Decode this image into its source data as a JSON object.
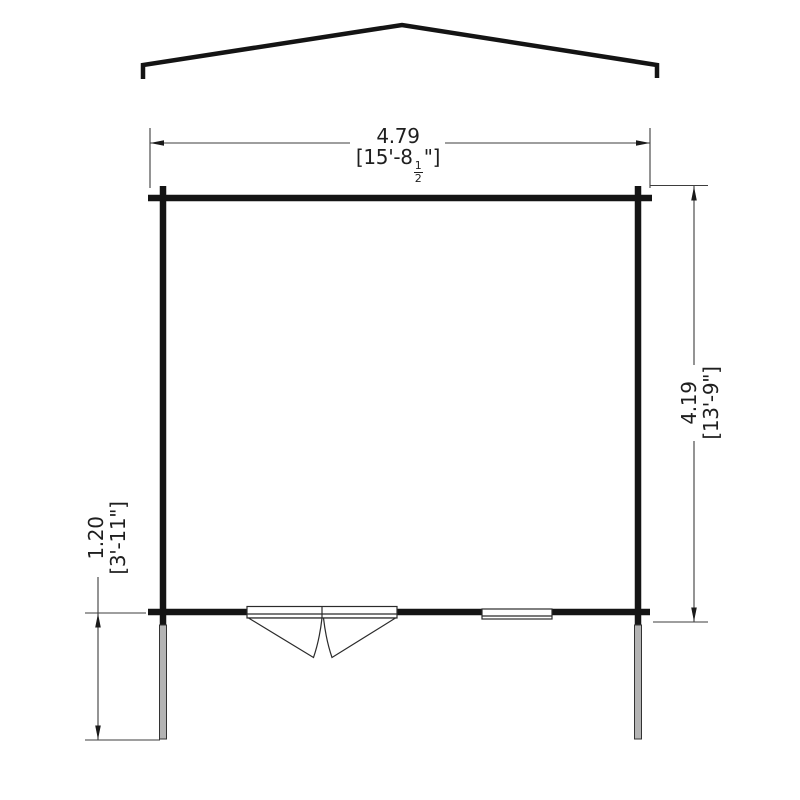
{
  "plan": {
    "dimensions": {
      "width": {
        "metric": "4.79",
        "imperial_prefix": "[15'-8",
        "fraction_numerator": "1",
        "fraction_denominator": "2",
        "imperial_suffix": "\"]"
      },
      "depth": {
        "metric": "4.19",
        "imperial": "[13'-9\"]"
      },
      "canopy": {
        "metric": "1.20",
        "imperial": "[3'-11\"]"
      }
    },
    "colors": {
      "background": "#ffffff",
      "wall_line": "#141414",
      "thin_line": "#3d3d3d",
      "post_fill": "#b4b4b4"
    }
  }
}
